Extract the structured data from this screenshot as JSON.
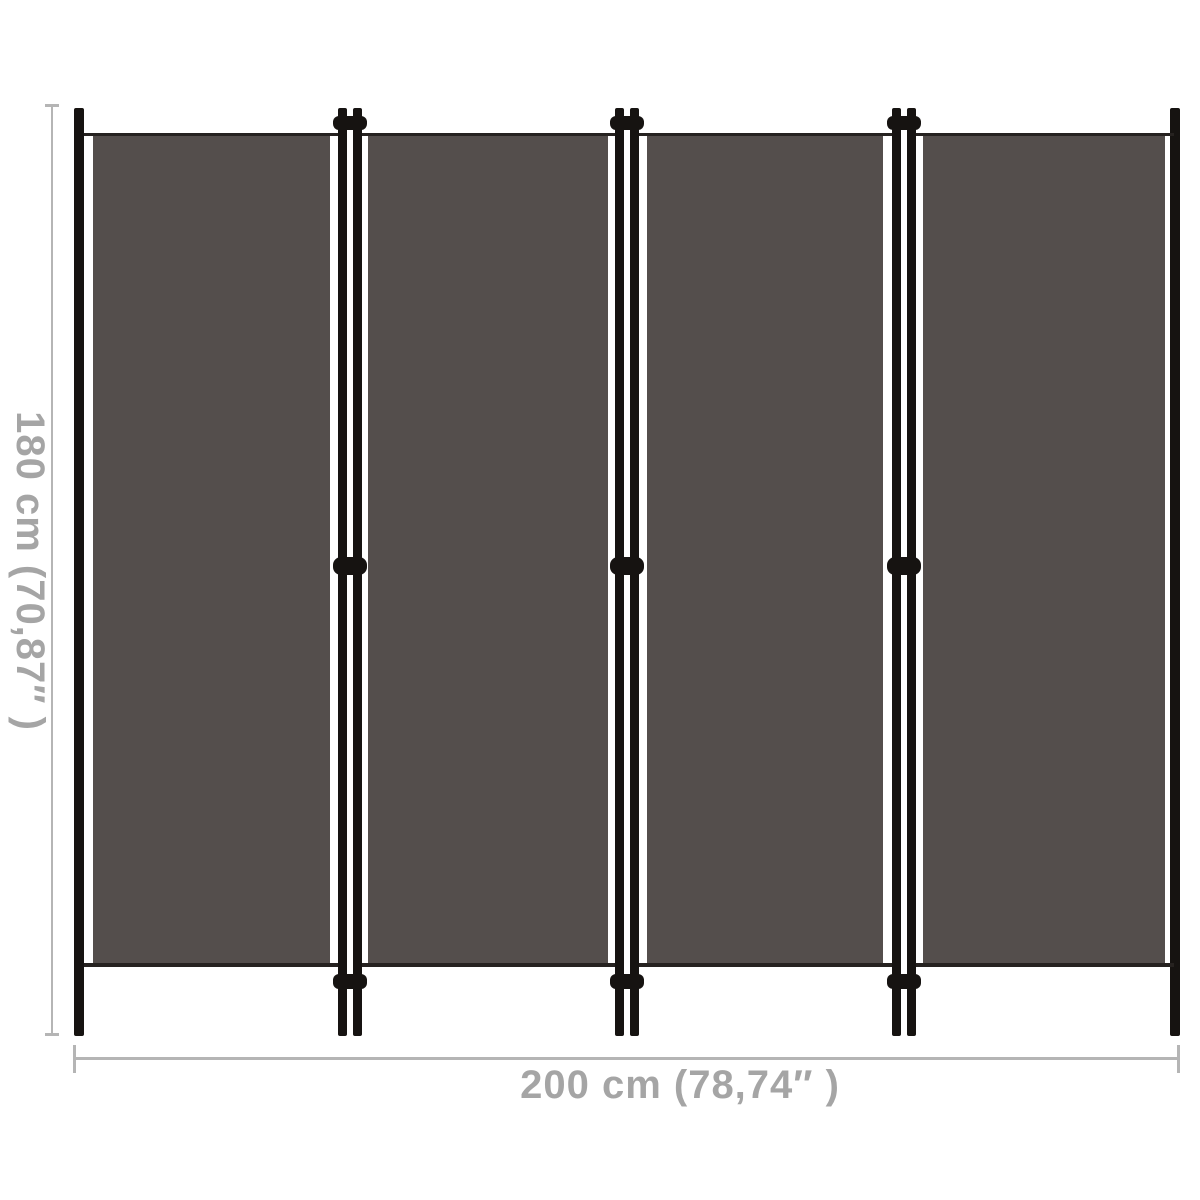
{
  "diagram": {
    "type": "product-dimension-diagram",
    "subject": "4-panel folding room divider screen",
    "panel_count": 4,
    "junction_count": 3,
    "hinges_per_junction": 3,
    "height_label": "180 cm (70,87″ )",
    "width_label": "200 cm (78,74″ )"
  },
  "colors": {
    "bg": "#ffffff",
    "fabric": "#544e4c",
    "fabric-edge": "#262220",
    "frame": "#161311",
    "dim-line": "#b5b5b5",
    "dim-text": "#a5a5a5"
  }
}
